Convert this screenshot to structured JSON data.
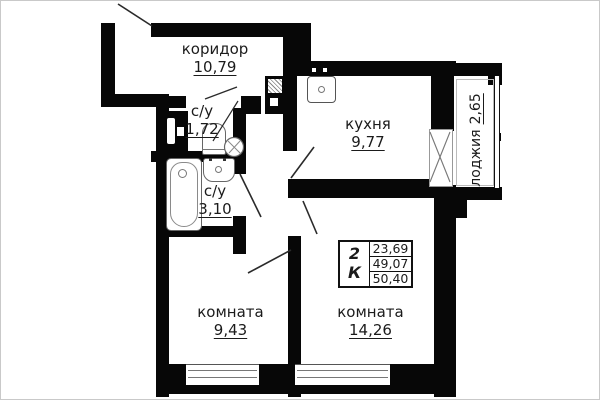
{
  "plan": {
    "rooms": [
      {
        "id": "corridor",
        "name": "коридор",
        "area": "10,79"
      },
      {
        "id": "wc-small",
        "name": "с/у",
        "area": "1,72"
      },
      {
        "id": "kitchen",
        "name": "кухня",
        "area": "9,77"
      },
      {
        "id": "wc-large",
        "name": "с/у",
        "area": "3,10"
      },
      {
        "id": "loggia",
        "name": "лоджия",
        "area": "2,65"
      },
      {
        "id": "room-1",
        "name": "комната",
        "area": "9,43"
      },
      {
        "id": "room-2",
        "name": "комната",
        "area": "14,26"
      }
    ],
    "stamp": {
      "type": "2 К",
      "values": [
        "23,69",
        "49,07",
        "50,40"
      ]
    },
    "colors": {
      "wall": "#070707",
      "text": "#1b1b1b",
      "door_line": "#2a2a2a",
      "fixture": "#666666",
      "background": "#ffffff"
    }
  }
}
